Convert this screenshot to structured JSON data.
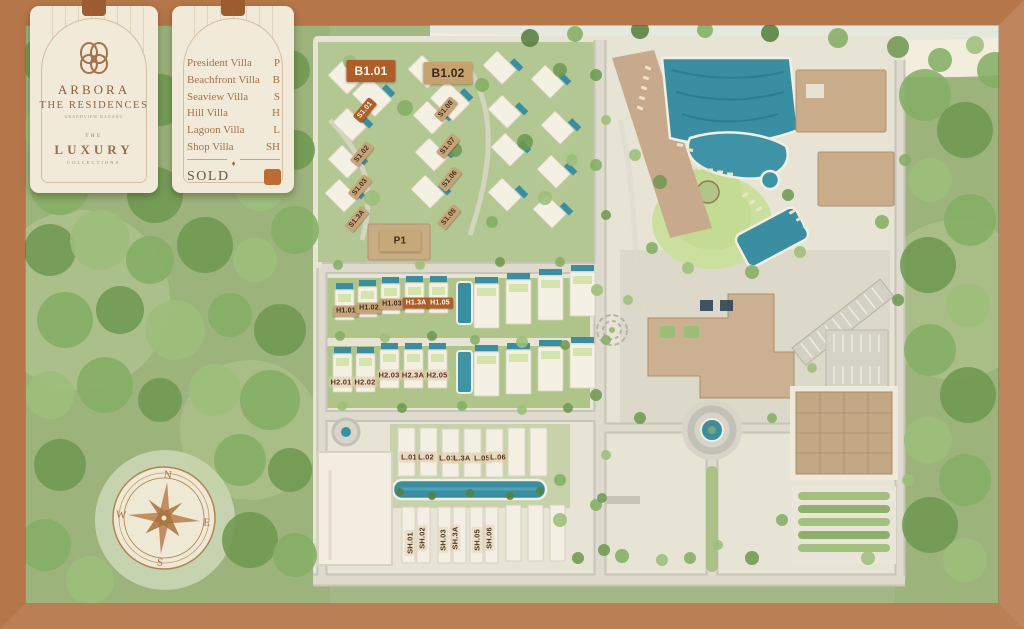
{
  "brand": {
    "name_line1": "ARBORA",
    "name_line2": "THE RESIDENCES",
    "tagline": "GRANDVIEW DANANG",
    "collection_the": "THE",
    "collection_name": "LUXURY",
    "collection_sub": "COLLECTION®"
  },
  "legend": {
    "items": [
      {
        "label": "President Villa",
        "code": "P"
      },
      {
        "label": "Beachfront Villa",
        "code": "B"
      },
      {
        "label": "Seaview Villa",
        "code": "S"
      },
      {
        "label": "Hill Villa",
        "code": "H"
      },
      {
        "label": "Lagoon Villa",
        "code": "L"
      },
      {
        "label": "Shop Villa",
        "code": "SH"
      }
    ],
    "divider_glyph": "♦",
    "sold_label": "SOLD",
    "sold_color": "#bc6b33"
  },
  "compass": {
    "north": "N",
    "east": "E",
    "south": "S",
    "west": "W"
  },
  "colors": {
    "frame": "#b5764a",
    "card": "#f1ead9",
    "brand_text": "#8d6243",
    "sold_plaque": "#b05e28",
    "available_plaque": "#c6a478",
    "pool": "#3a8ea2",
    "lawn": "#cbe09e",
    "building_tan": "#cbb091"
  },
  "map": {
    "plots": [
      {
        "label": "B1.01",
        "x": 371,
        "y": 71,
        "rot": 0,
        "style": "b",
        "status": "sold"
      },
      {
        "label": "B1.02",
        "x": 448,
        "y": 73,
        "rot": 0,
        "style": "b",
        "status": "available"
      },
      {
        "label": "S1.01",
        "x": 365,
        "y": 110,
        "rot": -50,
        "style": "s",
        "status": "sold"
      },
      {
        "label": "S1.08",
        "x": 446,
        "y": 109,
        "rot": -50,
        "style": "s",
        "status": "available"
      },
      {
        "label": "S1.02",
        "x": 362,
        "y": 154,
        "rot": -50,
        "style": "s",
        "status": "available"
      },
      {
        "label": "S1.07",
        "x": 448,
        "y": 146,
        "rot": -50,
        "style": "s",
        "status": "available"
      },
      {
        "label": "S1.03",
        "x": 360,
        "y": 187,
        "rot": -50,
        "style": "s",
        "status": "available"
      },
      {
        "label": "S1.06",
        "x": 450,
        "y": 179,
        "rot": -50,
        "style": "s",
        "status": "available"
      },
      {
        "label": "S1.3A",
        "x": 357,
        "y": 219,
        "rot": -50,
        "style": "s",
        "status": "available"
      },
      {
        "label": "S1.05",
        "x": 449,
        "y": 217,
        "rot": -50,
        "style": "s",
        "status": "available"
      },
      {
        "label": "P1",
        "x": 400,
        "y": 241,
        "rot": 0,
        "style": "p",
        "status": "available"
      },
      {
        "label": "H1.01",
        "x": 346,
        "y": 311,
        "rot": 0,
        "style": "s",
        "status": "available"
      },
      {
        "label": "H1.02",
        "x": 369,
        "y": 308,
        "rot": 0,
        "style": "s",
        "status": "available"
      },
      {
        "label": "H1.03",
        "x": 392,
        "y": 304,
        "rot": 0,
        "style": "s",
        "status": "available"
      },
      {
        "label": "H1.3A",
        "x": 416,
        "y": 303,
        "rot": 0,
        "style": "s",
        "status": "sold"
      },
      {
        "label": "H1.05",
        "x": 440,
        "y": 303,
        "rot": 0,
        "style": "s",
        "status": "sold"
      },
      {
        "label": "H2.01",
        "x": 341,
        "y": 382,
        "rot": 0,
        "style": "chip",
        "status": "available"
      },
      {
        "label": "H2.02",
        "x": 365,
        "y": 382,
        "rot": 0,
        "style": "chip",
        "status": "available"
      },
      {
        "label": "H2.03",
        "x": 389,
        "y": 375,
        "rot": 0,
        "style": "chip",
        "status": "available"
      },
      {
        "label": "H2.3A",
        "x": 413,
        "y": 375,
        "rot": 0,
        "style": "chip",
        "status": "available"
      },
      {
        "label": "H2.05",
        "x": 437,
        "y": 375,
        "rot": 0,
        "style": "chip",
        "status": "available"
      },
      {
        "label": "L.01",
        "x": 409,
        "y": 457,
        "rot": 0,
        "style": "chip",
        "status": "available"
      },
      {
        "label": "L.02",
        "x": 426,
        "y": 457,
        "rot": 0,
        "style": "chip",
        "status": "available"
      },
      {
        "label": "L.03",
        "x": 447,
        "y": 458,
        "rot": 0,
        "style": "chip",
        "status": "available"
      },
      {
        "label": "L.3A",
        "x": 462,
        "y": 458,
        "rot": 0,
        "style": "chip",
        "status": "available"
      },
      {
        "label": "L.05",
        "x": 482,
        "y": 458,
        "rot": 0,
        "style": "chip",
        "status": "available"
      },
      {
        "label": "L.06",
        "x": 498,
        "y": 457,
        "rot": 0,
        "style": "chip",
        "status": "available"
      },
      {
        "label": "SH.01",
        "x": 410,
        "y": 543,
        "rot": -90,
        "style": "vchip",
        "status": "available"
      },
      {
        "label": "SH.02",
        "x": 422,
        "y": 538,
        "rot": -90,
        "style": "vchip",
        "status": "available"
      },
      {
        "label": "SH.03",
        "x": 443,
        "y": 540,
        "rot": -90,
        "style": "vchip",
        "status": "available"
      },
      {
        "label": "SH.3A",
        "x": 455,
        "y": 538,
        "rot": -90,
        "style": "vchip",
        "status": "available"
      },
      {
        "label": "SH.05",
        "x": 477,
        "y": 540,
        "rot": -90,
        "style": "vchip",
        "status": "available"
      },
      {
        "label": "SH.06",
        "x": 489,
        "y": 538,
        "rot": -90,
        "style": "vchip",
        "status": "available"
      }
    ]
  }
}
